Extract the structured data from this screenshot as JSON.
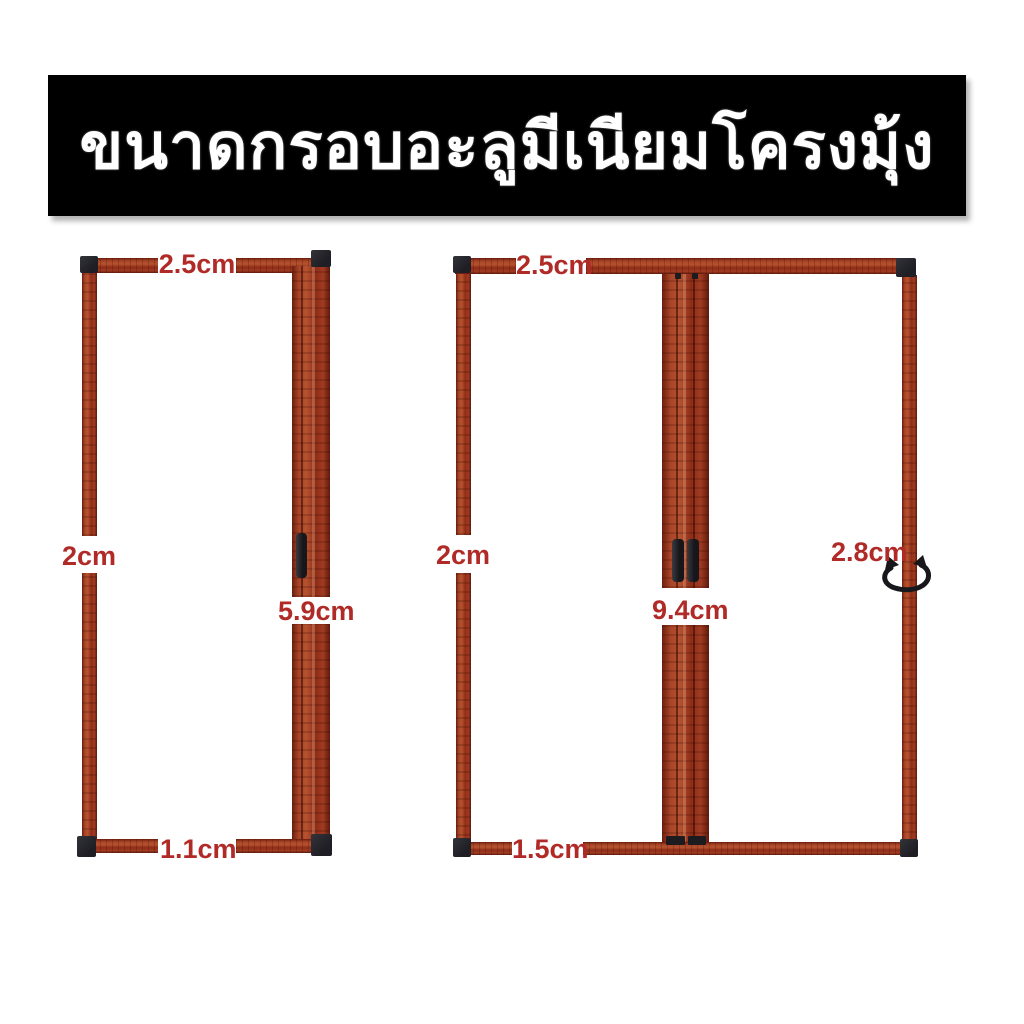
{
  "banner": {
    "title": "ขนาดกรอบอะลูมีเนียมโครงมุ้ง"
  },
  "colors": {
    "banner_bg": "#000000",
    "banner_text": "#ffffff",
    "dimension_text": "#b02b27",
    "wood_frame": "#a03b22",
    "corner_connector": "#26262c"
  },
  "left_frame": {
    "dimensions": {
      "top": "2.5cm",
      "left": "2cm",
      "right": "5.9cm",
      "bottom": "1.1cm"
    }
  },
  "right_frame": {
    "dimensions": {
      "top": "2.5cm",
      "left": "2cm",
      "center": "9.4cm",
      "right": "2.8cm",
      "bottom": "1.5cm"
    }
  }
}
